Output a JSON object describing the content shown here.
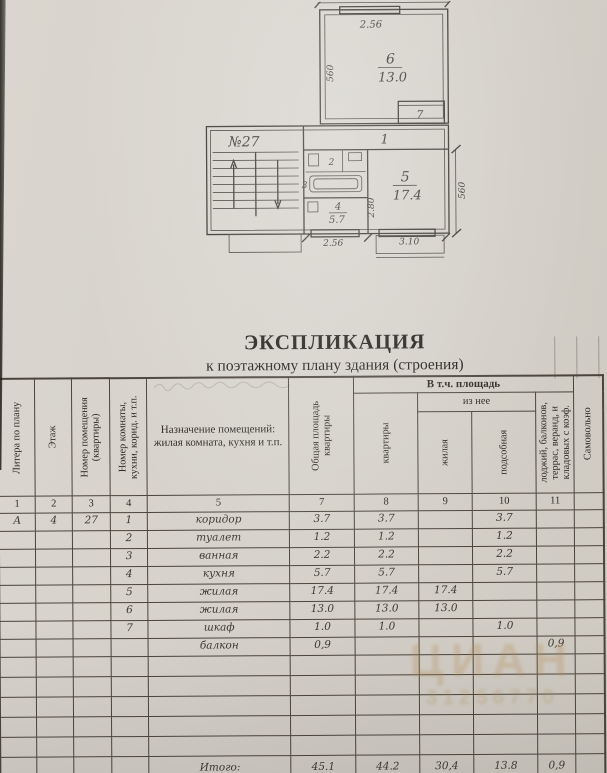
{
  "document": {
    "title": "ЭКСПЛИКАЦИЯ",
    "subtitle": "к поэтажному плану здания (строения)"
  },
  "plan": {
    "apartment_label": "№27",
    "room1_num": "1",
    "room2_num": "2",
    "room3_num": "3",
    "room4_num": "4",
    "room4_area": "5.7",
    "room5_num": "5",
    "room5_area": "17.4",
    "room6_num": "6",
    "room6_area": "13.0",
    "room7_num": "7",
    "dim_top": "2.56",
    "dim_room6_left": "560",
    "dim_room5_right": "560",
    "dim_kitchen_height": "2.80",
    "dim_kitchen_bottom": "2.56",
    "dim_room5_bottom": "3.10"
  },
  "table": {
    "group_total": "В т.ч. площадь",
    "group_of_it": "из нее",
    "columns": [
      {
        "num": "1",
        "label": "Литера по плану"
      },
      {
        "num": "2",
        "label": "Этаж"
      },
      {
        "num": "3",
        "label": "Номер помещения (квартиры)"
      },
      {
        "num": "4",
        "label": "Номер комнаты, кухни, корид. и т.п."
      },
      {
        "num": "5",
        "label": "Назначение помещений: жилая комната, кухня и т.п."
      },
      {
        "num": "7",
        "label": "Общая площадь квартиры"
      },
      {
        "num": "8",
        "label": "квартиры"
      },
      {
        "num": "9",
        "label": "жилая"
      },
      {
        "num": "10",
        "label": "подсобная"
      },
      {
        "num": "11",
        "label": "лоджий, балконов, террас, веранд, и кладовых с коэф."
      },
      {
        "num": "",
        "label": "Самовольно"
      }
    ],
    "rows": [
      {
        "litera": "А",
        "floor": "4",
        "apt": "27",
        "room": "1",
        "purpose": "коридор",
        "total": "3.7",
        "apt_area": "3.7",
        "living": "",
        "auxiliary": "3.7",
        "balcony": ""
      },
      {
        "litera": "",
        "floor": "",
        "apt": "",
        "room": "2",
        "purpose": "туалет",
        "total": "1.2",
        "apt_area": "1.2",
        "living": "",
        "auxiliary": "1.2",
        "balcony": ""
      },
      {
        "litera": "",
        "floor": "",
        "apt": "",
        "room": "3",
        "purpose": "ванная",
        "total": "2.2",
        "apt_area": "2.2",
        "living": "",
        "auxiliary": "2.2",
        "balcony": ""
      },
      {
        "litera": "",
        "floor": "",
        "apt": "",
        "room": "4",
        "purpose": "кухня",
        "total": "5.7",
        "apt_area": "5.7",
        "living": "",
        "auxiliary": "5.7",
        "balcony": ""
      },
      {
        "litera": "",
        "floor": "",
        "apt": "",
        "room": "5",
        "purpose": "жилая",
        "total": "17.4",
        "apt_area": "17.4",
        "living": "17.4",
        "auxiliary": "",
        "balcony": ""
      },
      {
        "litera": "",
        "floor": "",
        "apt": "",
        "room": "6",
        "purpose": "жилая",
        "total": "13.0",
        "apt_area": "13.0",
        "living": "13.0",
        "auxiliary": "",
        "balcony": ""
      },
      {
        "litera": "",
        "floor": "",
        "apt": "",
        "room": "7",
        "purpose": "шкаф",
        "total": "1.0",
        "apt_area": "1.0",
        "living": "",
        "auxiliary": "1.0",
        "balcony": ""
      },
      {
        "litera": "",
        "floor": "",
        "apt": "",
        "room": "",
        "purpose": "балкон",
        "total": "0,9",
        "apt_area": "",
        "living": "",
        "auxiliary": "",
        "balcony": "0,9"
      }
    ],
    "totals": {
      "label": "Итого:",
      "total": "45.1",
      "apt_area": "44.2",
      "living": "30,4",
      "auxiliary": "13.8",
      "balcony": "0,9"
    }
  },
  "watermark": {
    "line1": "ЦИАН",
    "line2": "31256770"
  }
}
